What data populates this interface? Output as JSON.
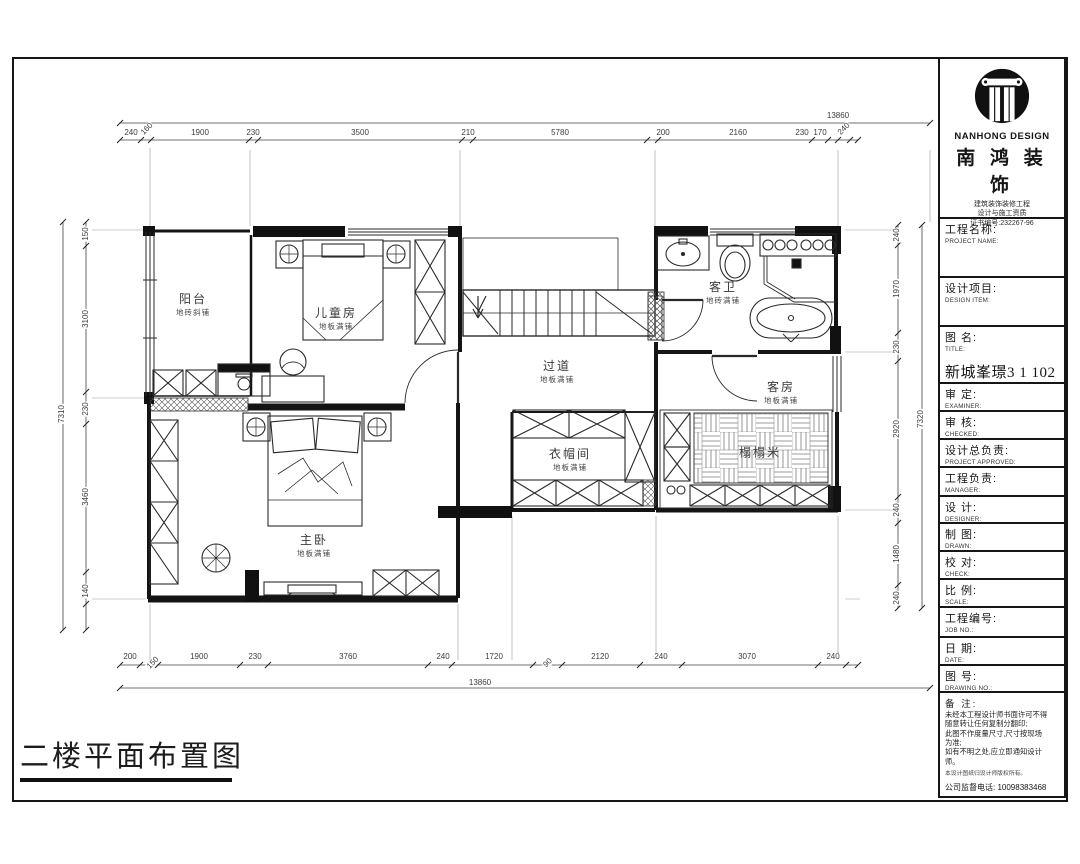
{
  "sheet": {
    "title": "二楼平面布置图"
  },
  "compass": {
    "a": "A",
    "b": "B",
    "c": "C",
    "d": "D"
  },
  "rooms": {
    "balcony": {
      "name": "阳台",
      "finish": "地砖斜铺"
    },
    "kids": {
      "name": "儿童房",
      "finish": "地板满铺"
    },
    "hallway": {
      "name": "过道",
      "finish": "地板满铺"
    },
    "bath": {
      "name": "客卫",
      "finish": "地砖满铺"
    },
    "guest": {
      "name": "客房",
      "finish": "地板满铺"
    },
    "cloak": {
      "name": "衣帽间",
      "finish": "地板满铺"
    },
    "tatami": {
      "name": "榻榻米"
    },
    "master": {
      "name": "主卧",
      "finish": "地板满铺"
    }
  },
  "dimensions": {
    "top_overall": {
      "t": "13860",
      "x": 838,
      "y": 116
    },
    "bottom_overall": {
      "t": "13860",
      "x": 480,
      "y": 683
    },
    "left_overall": {
      "t": "7310",
      "x": 62,
      "y": 414
    },
    "right_overall": {
      "t": "7320",
      "x": 921,
      "y": 419
    },
    "top": [
      {
        "t": "240",
        "x": 131,
        "y": 133
      },
      {
        "t": "160",
        "x": 147,
        "y": 129,
        "slant": true
      },
      {
        "t": "1900",
        "x": 200,
        "y": 133
      },
      {
        "t": "230",
        "x": 253,
        "y": 133
      },
      {
        "t": "3500",
        "x": 360,
        "y": 133
      },
      {
        "t": "210",
        "x": 468,
        "y": 133
      },
      {
        "t": "5780",
        "x": 560,
        "y": 133
      },
      {
        "t": "200",
        "x": 663,
        "y": 133
      },
      {
        "t": "2160",
        "x": 738,
        "y": 133
      },
      {
        "t": "230",
        "x": 802,
        "y": 133
      },
      {
        "t": "170",
        "x": 820,
        "y": 133
      },
      {
        "t": "240",
        "x": 844,
        "y": 129,
        "slant": true
      }
    ],
    "bottom": [
      {
        "t": "200",
        "x": 130,
        "y": 657
      },
      {
        "t": "150",
        "x": 153,
        "y": 663,
        "slant": true
      },
      {
        "t": "1900",
        "x": 199,
        "y": 657
      },
      {
        "t": "230",
        "x": 255,
        "y": 657
      },
      {
        "t": "3760",
        "x": 348,
        "y": 657
      },
      {
        "t": "240",
        "x": 443,
        "y": 657
      },
      {
        "t": "1720",
        "x": 494,
        "y": 657
      },
      {
        "t": "90",
        "x": 548,
        "y": 663,
        "slant": true
      },
      {
        "t": "2120",
        "x": 600,
        "y": 657
      },
      {
        "t": "240",
        "x": 661,
        "y": 657
      },
      {
        "t": "3070",
        "x": 747,
        "y": 657
      },
      {
        "t": "240",
        "x": 833,
        "y": 657
      }
    ],
    "left": [
      {
        "t": "150",
        "y": 234
      },
      {
        "t": "3100",
        "y": 319
      },
      {
        "t": "230",
        "y": 409
      },
      {
        "t": "3460",
        "y": 497
      },
      {
        "t": "140",
        "y": 591
      }
    ],
    "right": [
      {
        "t": "240",
        "y": 235
      },
      {
        "t": "1970",
        "y": 289
      },
      {
        "t": "230",
        "y": 347
      },
      {
        "t": "2920",
        "y": 429
      },
      {
        "t": "240",
        "y": 510
      },
      {
        "t": "1480",
        "y": 554
      },
      {
        "t": "240",
        "y": 598
      }
    ]
  },
  "title_block": {
    "brand_en": "NANHONG DESIGN",
    "brand_cn": "南 鸿 装 饰",
    "cert_lines": [
      "建筑装饰装修工程",
      "设计与施工资质",
      "证书编号:232267-96"
    ],
    "fields": [
      {
        "cn": "工程名称:",
        "en": "PROJECT NAME:"
      },
      {
        "cn": "设计项目:",
        "en": "DESIGN ITEM:"
      },
      {
        "cn": "图  名:",
        "en": "TITLE:",
        "value": "新城峯璟3 1 102"
      },
      {
        "cn": "审  定:",
        "en": "EXAMINER:"
      },
      {
        "cn": "审  核:",
        "en": "CHECKED:"
      },
      {
        "cn": "设计总负责:",
        "en": "PROJECT APPROVED:"
      },
      {
        "cn": "工程负责:",
        "en": "MANAGER:"
      },
      {
        "cn": "设  计:",
        "en": "DESIGNER:"
      },
      {
        "cn": "制  图:",
        "en": "DRAWN:"
      },
      {
        "cn": "校  对:",
        "en": "CHECK:"
      },
      {
        "cn": "比  例:",
        "en": "SCALE:"
      },
      {
        "cn": "工程编号:",
        "en": "JOB NO.:"
      },
      {
        "cn": "日  期:",
        "en": "DATE:"
      },
      {
        "cn": "图  号:",
        "en": "DRAWING NO.:"
      }
    ],
    "notes_title": "备 注:",
    "notes": [
      "未经本工程设计师书面许可不得",
      "随意转让任何复制分翻印;",
      "此图不作度量尺寸,尺寸按现场",
      "为准;",
      "如有不明之处,应立即通知设计",
      "师。"
    ],
    "notes_small": "本设计图纸归设计师版权所有。",
    "hotline": "公司监督电话: 10098383468"
  },
  "colors": {
    "line": "#161616",
    "dim_text": "#3c3c3c"
  }
}
